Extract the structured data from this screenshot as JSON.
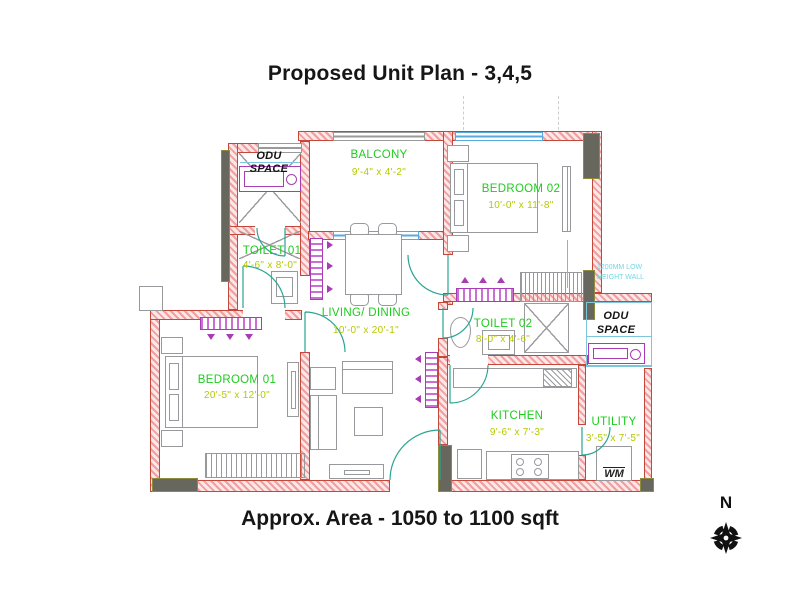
{
  "title": "Proposed Unit Plan - 3,4,5",
  "footer": "Approx. Area - 1050 to 1100 sqft",
  "compass": {
    "north": "N"
  },
  "rooms": {
    "balcony": {
      "name": "BALCONY",
      "dim": "9'-4\" x 4'-2\""
    },
    "bedroom02": {
      "name": "BEDROOM 02",
      "dim": "10'-0\" x 11'-8\""
    },
    "toilet01": {
      "name": "TOILET 01",
      "dim": "4'-6\" x 8'-0\""
    },
    "living": {
      "name": "LIVING/ DINING",
      "dim": "10'-0\" x 20'-1\""
    },
    "toilet02": {
      "name": "TOILET 02",
      "dim": "8'-0\" x 4'-6\""
    },
    "bedroom01": {
      "name": "BEDROOM 01",
      "dim": "20'-5\" x 12'-0\""
    },
    "kitchen": {
      "name": "KITCHEN",
      "dim": "9'-6\" x 7'-3\""
    },
    "utility": {
      "name": "UTILITY",
      "dim": "3'-5\" x 7'-5\""
    }
  },
  "annotations": {
    "odu_left": {
      "line1": "ODU",
      "line2": "SPACE"
    },
    "odu_right": {
      "line1": "ODU",
      "line2": "SPACE"
    },
    "low_wall_note": {
      "line1": "1200MM LOW",
      "line2": "HEIGHT WALL"
    },
    "washing_machine": "WM"
  },
  "colors": {
    "wall_hatch": "#f09e9e",
    "wall_line": "#c4473a",
    "room_label": "#1ecb1e",
    "dim_label": "#b5c900",
    "door": "#2aa493",
    "window": "#58aadc",
    "fixture": "#a93bb4",
    "note": "#6fd8e8",
    "column": "#67675d",
    "text": "#161616"
  }
}
